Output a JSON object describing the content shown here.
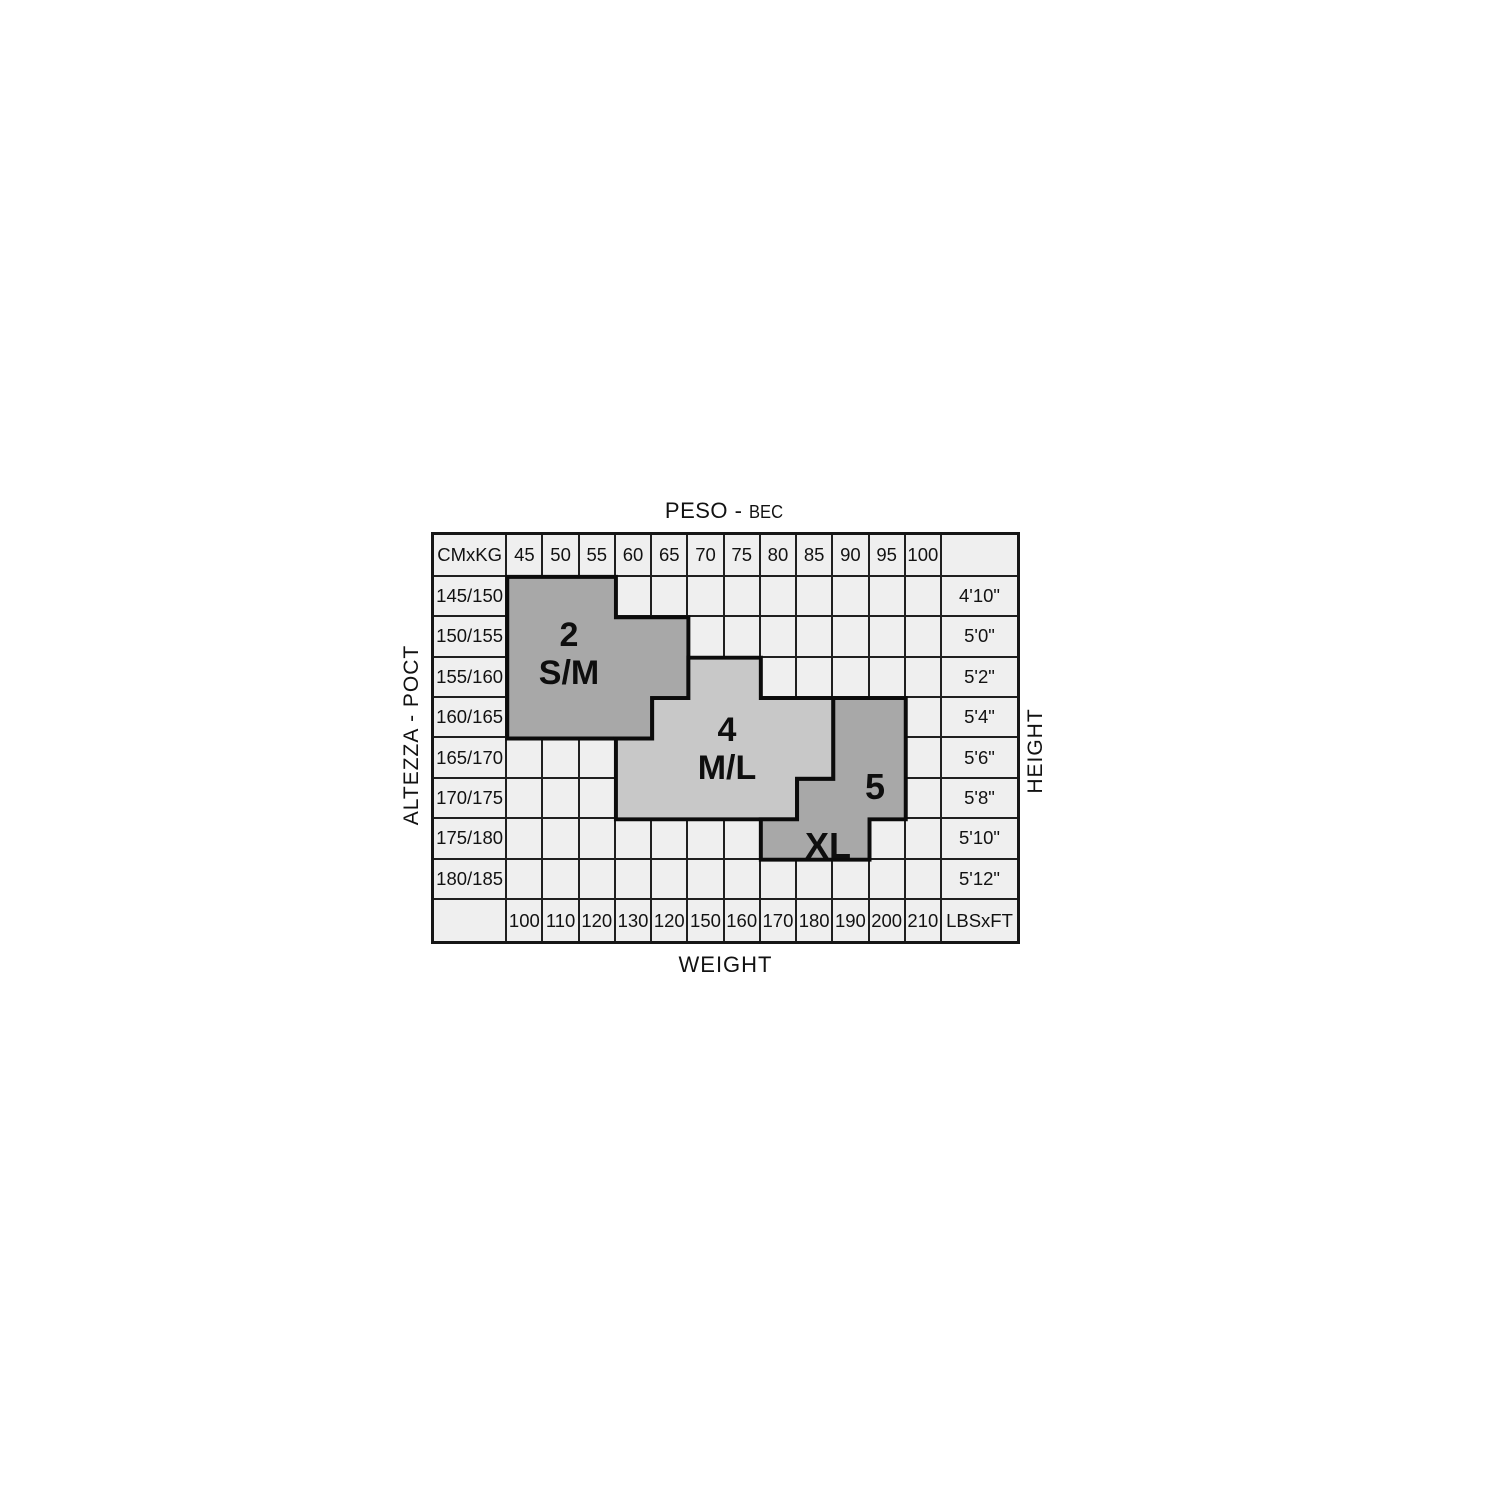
{
  "title": {
    "primary": "PESO -",
    "secondary": "BEC"
  },
  "bottom_label": "WEIGHT",
  "left_label": "ALTEZZA - POCT",
  "right_label": "HEIGHT",
  "corner_top": "CMxKG",
  "corner_bottom": "LBSxFT",
  "kg_values": [
    "45",
    "50",
    "55",
    "60",
    "65",
    "70",
    "75",
    "80",
    "85",
    "90",
    "95",
    "100"
  ],
  "lbs_values": [
    "100",
    "110",
    "120",
    "130",
    "120",
    "150",
    "160",
    "170",
    "180",
    "190",
    "200",
    "210"
  ],
  "cm_values": [
    "145/150",
    "150/155",
    "155/160",
    "160/165",
    "165/170",
    "170/175",
    "175/180",
    "180/185"
  ],
  "ft_values": [
    "4'10\"",
    "5'0\"",
    "5'2\"",
    "5'4\"",
    "5'6\"",
    "5'8\"",
    "5'10\"",
    "5'12\""
  ],
  "colors": {
    "page_bg": "#ffffff",
    "cell_bg": "#efefef",
    "grid_line": "#1f1f1f",
    "region_dark": "#a8a8a8",
    "region_light": "#c8c8c8",
    "region_border": "#0b0b0b",
    "text": "#121212"
  },
  "regions": [
    {
      "id": "sm",
      "fill": "#a8a8a8"
    },
    {
      "id": "ml",
      "fill": "#c8c8c8"
    },
    {
      "id": "xl5",
      "fill": "#a8a8a8"
    }
  ],
  "geometry": {
    "grid": {
      "left": 431,
      "top": 532,
      "width": 589,
      "height": 412
    },
    "col_edges": [
      0,
      74,
      110.6,
      147.2,
      183.8,
      220.4,
      257,
      293.6,
      330.2,
      366.8,
      403.4,
      440,
      476.6,
      513.2,
      589
    ],
    "row_edges": [
      0,
      42.5,
      83.5,
      124.5,
      165.5,
      206.5,
      247.5,
      288.5,
      329.5,
      370.5,
      412
    ],
    "outlines": {
      "sm": [
        [
          1,
          1
        ],
        [
          4,
          1
        ],
        [
          4,
          2
        ],
        [
          6,
          2
        ],
        [
          6,
          4
        ],
        [
          5,
          4
        ],
        [
          5,
          5
        ],
        [
          1,
          5
        ]
      ],
      "ml": [
        [
          6,
          3
        ],
        [
          8,
          3
        ],
        [
          8,
          4
        ],
        [
          10,
          4
        ],
        [
          10,
          6
        ],
        [
          9,
          6
        ],
        [
          9,
          7
        ],
        [
          4,
          7
        ],
        [
          4,
          5
        ],
        [
          5,
          5
        ],
        [
          5,
          4
        ],
        [
          6,
          4
        ]
      ],
      "xl5": [
        [
          10,
          4
        ],
        [
          12,
          4
        ],
        [
          12,
          7
        ],
        [
          11,
          7
        ],
        [
          11,
          8
        ],
        [
          8,
          8
        ],
        [
          8,
          7
        ],
        [
          9,
          7
        ],
        [
          9,
          6
        ],
        [
          10,
          6
        ]
      ]
    },
    "labels": [
      {
        "region": "sm",
        "lines": [
          "2",
          "S/M"
        ],
        "x": 135,
        "y": 119,
        "font": 34
      },
      {
        "region": "ml",
        "lines": [
          "4",
          "M/L"
        ],
        "x": 293,
        "y": 214,
        "font": 34
      },
      {
        "region": "five",
        "lines": [
          "5"
        ],
        "x": 441,
        "y": 252,
        "font": 36
      },
      {
        "region": "xl",
        "lines": [
          "XL"
        ],
        "x": 394,
        "y": 311,
        "font": 36
      }
    ]
  },
  "chart_data": {
    "type": "heatmap",
    "title": "PESO - BEC",
    "xlabel_bottom": "WEIGHT",
    "ylabel_left": "ALTEZZA - POCT",
    "ylabel_right": "HEIGHT",
    "x_kg": [
      45,
      50,
      55,
      60,
      65,
      70,
      75,
      80,
      85,
      90,
      95,
      100
    ],
    "x_lbs": [
      100,
      110,
      120,
      130,
      120,
      150,
      160,
      170,
      180,
      190,
      200,
      210
    ],
    "y_cm": [
      "145/150",
      "150/155",
      "155/160",
      "160/165",
      "165/170",
      "170/175",
      "175/180",
      "180/185"
    ],
    "y_ft": [
      "4'10\"",
      "5'0\"",
      "5'2\"",
      "5'4\"",
      "5'6\"",
      "5'8\"",
      "5'10\"",
      "5'12\""
    ],
    "size_regions": [
      {
        "size": "2 S/M",
        "shade": "dark",
        "kg_range_by_height": {
          "145/150": [
            45,
            55
          ],
          "150/155": [
            45,
            65
          ],
          "155/160": [
            45,
            65
          ],
          "160/165": [
            45,
            60
          ]
        }
      },
      {
        "size": "4 M/L",
        "shade": "light",
        "kg_range_by_height": {
          "155/160": [
            70,
            75
          ],
          "160/165": [
            65,
            85
          ],
          "165/170": [
            60,
            85
          ],
          "170/175": [
            60,
            80
          ]
        }
      },
      {
        "size": "5",
        "shade": "dark",
        "kg_range_by_height": {
          "160/165": [
            90,
            95
          ],
          "165/170": [
            90,
            95
          ],
          "170/175": [
            85,
            95
          ]
        }
      },
      {
        "size": "XL",
        "shade": "dark",
        "kg_range_by_height": {
          "175/180": [
            80,
            90
          ]
        }
      }
    ]
  }
}
